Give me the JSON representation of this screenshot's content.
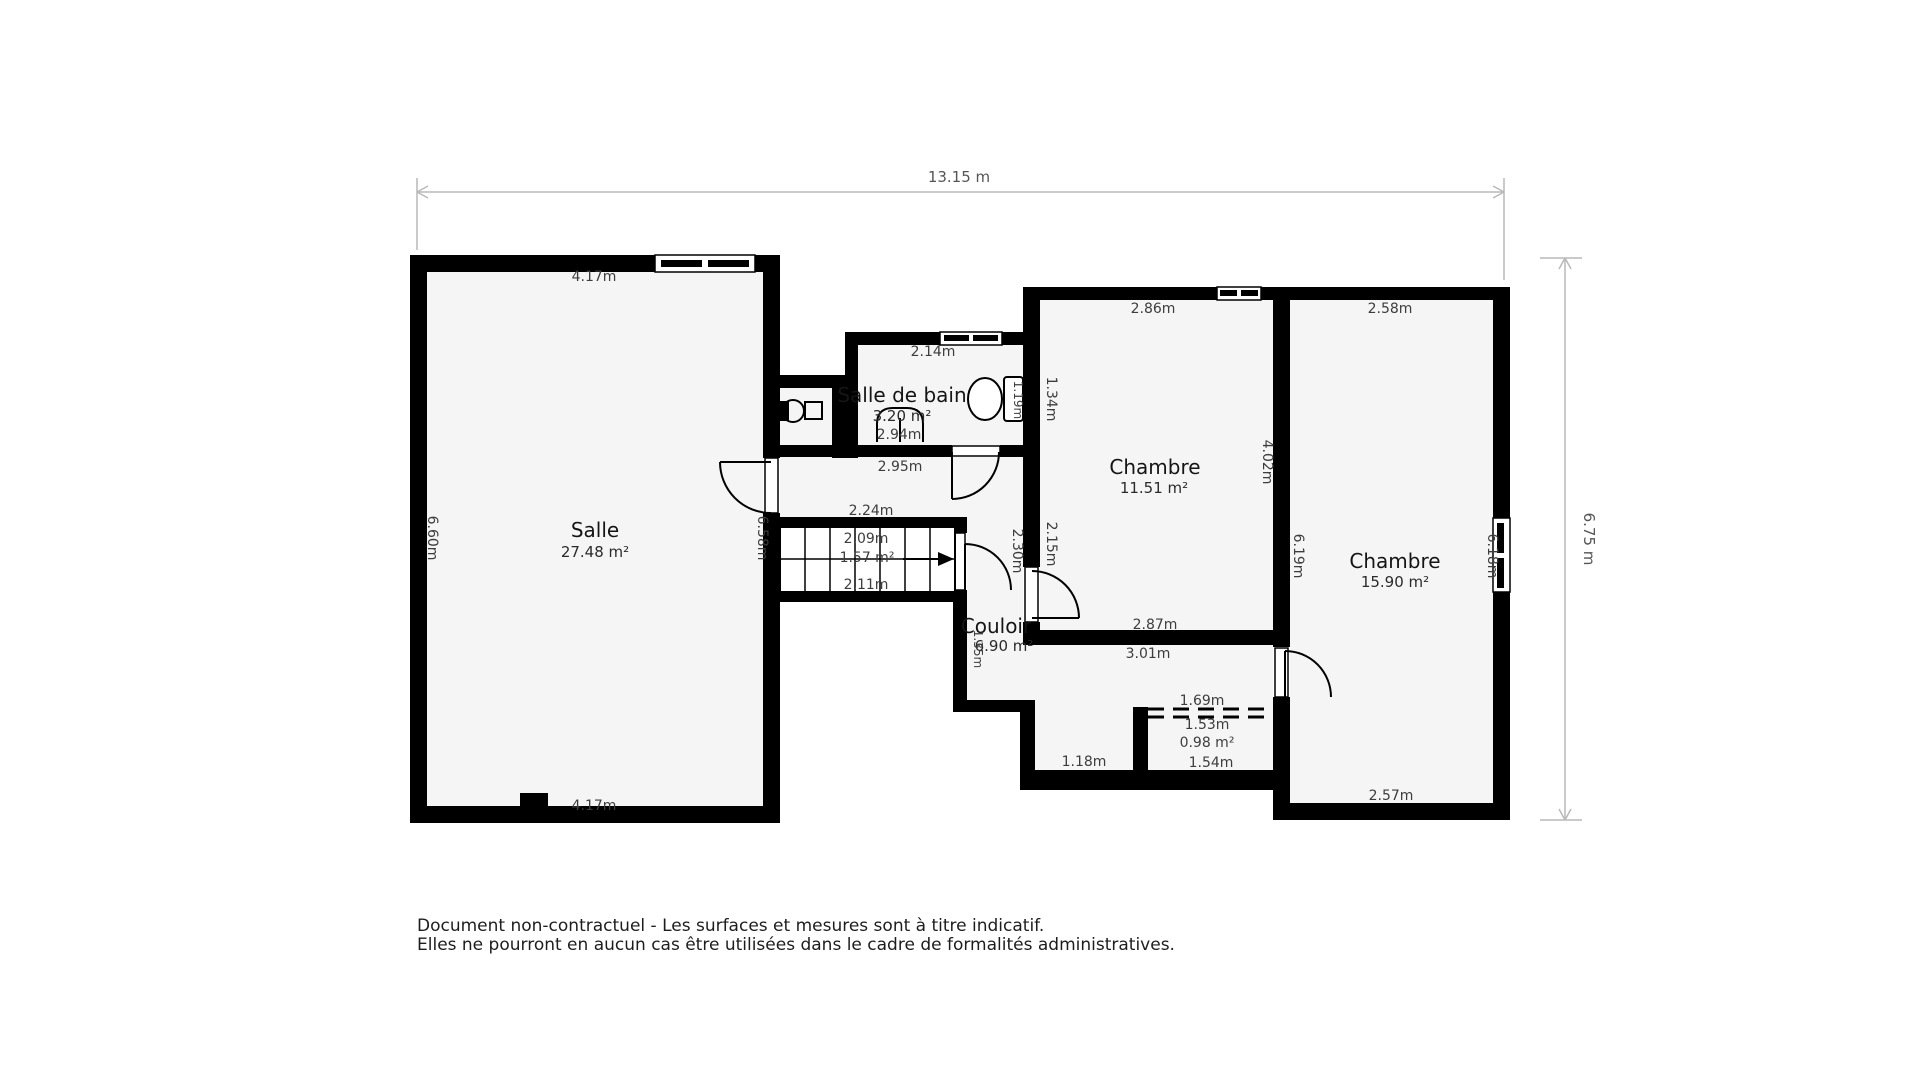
{
  "overall": {
    "width": "13.15 m",
    "height": "6.75 m"
  },
  "rooms": {
    "salle": {
      "name": "Salle",
      "area": "27.48 m²",
      "dim_top": "4.17m",
      "dim_bottom": "4.17m",
      "dim_left": "6.60m",
      "dim_right": "6.58m"
    },
    "salle_de_bain": {
      "name": "Salle de bain",
      "area": "3.20 m²",
      "dim_top": "2.14m",
      "dim_bottom": "2.94m",
      "dim_right": "1.19m"
    },
    "chambre_1": {
      "name": "Chambre",
      "area": "11.51 m²",
      "dim_top": "2.86m",
      "dim_bottom": "2.87m",
      "dim_left_upper": "1.34m",
      "dim_left_lower": "2.15m",
      "dim_right": "4.02m"
    },
    "chambre_2": {
      "name": "Chambre",
      "area": "15.90 m²",
      "dim_top": "2.58m",
      "dim_bottom": "2.57m",
      "dim_left": "6.19m",
      "dim_right": "6.18m"
    },
    "couloir": {
      "name": "Couloir",
      "area": "6.90 m²",
      "dim_top": "2.95m",
      "dim_above_stairs": "2.24m",
      "dim_right": "2.30m",
      "dim_left_lower": "1.35m",
      "dim_south_top": "3.01m",
      "dim_south_bottom": "1.18m"
    },
    "escalier": {
      "dim_top": "2.09m",
      "area": "1.57 m²",
      "dim_bottom": "2.11m"
    },
    "placard": {
      "area": "0.98 m²",
      "dim_top": "1.69m",
      "dim_width_top": "1.53m",
      "dim_width_bottom": "1.54m"
    }
  },
  "footer": {
    "line1": "Document non-contractuel - Les surfaces et mesures sont à titre indicatif.",
    "line2": "Elles ne pourront en aucun cas être utilisées dans le cadre de formalités administratives."
  },
  "colors": {
    "wall": "#000000",
    "floor": "#f5f5f5",
    "dimension_line": "#b9b9b9"
  }
}
